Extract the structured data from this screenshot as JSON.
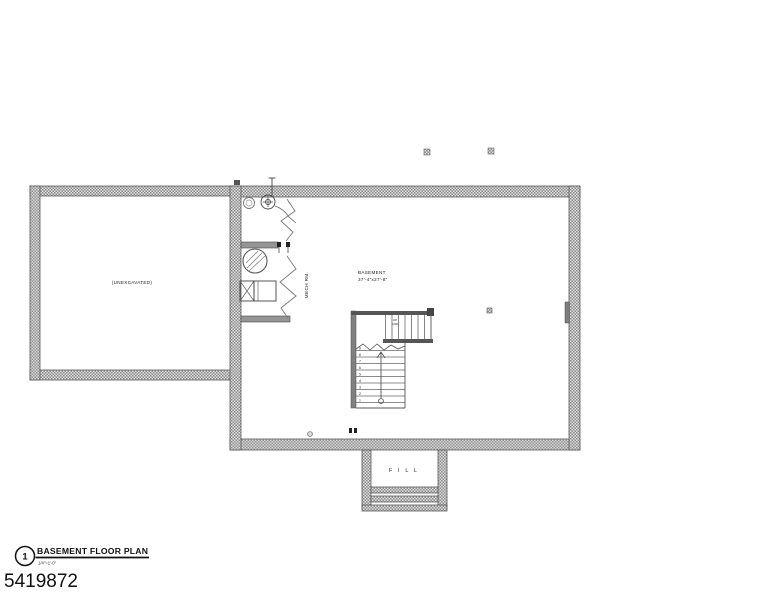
{
  "plan": {
    "unexcavated_label": "(UNEXCAVATED)",
    "basement_label": "BASEMENT",
    "basement_dims": "37'-4\"x27'-8\"",
    "mech_label": "MECH RM.",
    "fill_label": "F I L L",
    "stair_note_line1": "UP",
    "stair_note_line2": "14R",
    "riser_numbers": [
      "9",
      "8",
      "7",
      "6",
      "5",
      "4",
      "3",
      "2",
      "1"
    ]
  },
  "titleblock": {
    "detail_number": "1",
    "title": "BASEMENT FLOOR PLAN",
    "scale": "1/4\"=1'-0\""
  },
  "footer": {
    "sheet_id": "5419872"
  },
  "colors": {
    "wall_hatch_dark": "#8e8e8e",
    "wall_hatch_light": "#dcdcdc",
    "wall_edge": "#5a5a5a",
    "line": "#444444",
    "text": "#111111",
    "background": "#ffffff"
  }
}
